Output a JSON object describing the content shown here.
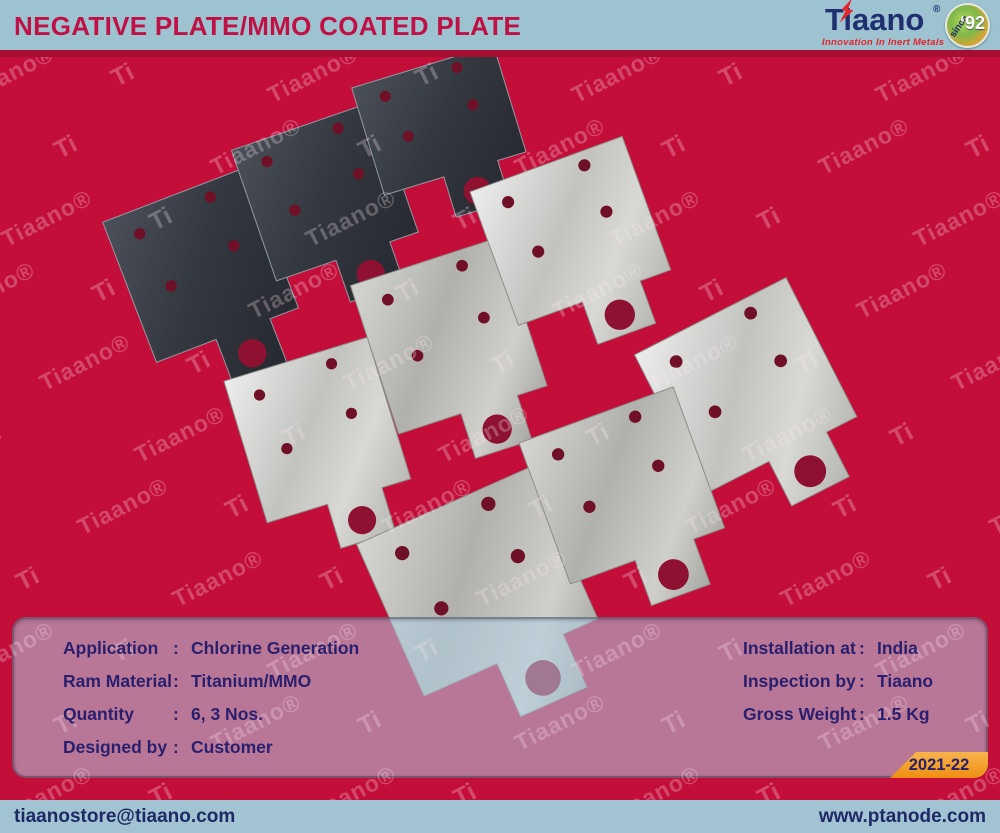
{
  "header": {
    "title": "NEGATIVE PLATE/MMO COATED PLATE",
    "logo": {
      "brand": "Tiaano",
      "registered": "®",
      "tagline": "Innovation In Inert Metals",
      "badge": {
        "since": "since",
        "year": "‘92"
      }
    }
  },
  "photo": {
    "watermark": {
      "brand": "Tiaano®",
      "short": "Ti"
    },
    "colors": {
      "background": "#c30e3a",
      "hole_small": "#701026",
      "hole_big": "#8e1132",
      "dark_stroke": "#9099a3",
      "silver_stroke": "#8d8e8a"
    },
    "plates": [
      {
        "name": "mmo-coated-plate-1",
        "finish": "dark",
        "shade": "",
        "cx": 209,
        "cy": 287,
        "w": 152,
        "h": 150,
        "t": 47,
        "rot": -21
      },
      {
        "name": "mmo-coated-plate-2",
        "finish": "dark",
        "shade": "",
        "cx": 332,
        "cy": 212,
        "w": 150,
        "h": 138,
        "t": 44,
        "rot": -19
      },
      {
        "name": "mmo-coated-plate-3",
        "finish": "dark",
        "shade": "",
        "cx": 445,
        "cy": 140,
        "w": 148,
        "h": 112,
        "t": 42,
        "rot": -17
      },
      {
        "name": "titanium-plate-1",
        "finish": "silver",
        "shade": "a",
        "cx": 324,
        "cy": 452,
        "w": 150,
        "h": 148,
        "t": 46,
        "rot": -17
      },
      {
        "name": "titanium-plate-2",
        "finish": "silver",
        "shade": "b",
        "cx": 456,
        "cy": 358,
        "w": 156,
        "h": 156,
        "t": 47,
        "rot": -18
      },
      {
        "name": "titanium-plate-3",
        "finish": "silver",
        "shade": "a",
        "cx": 578,
        "cy": 252,
        "w": 162,
        "h": 142,
        "t": 45,
        "rot": -20
      },
      {
        "name": "titanium-plate-4",
        "finish": "silver",
        "shade": "b",
        "cx": 489,
        "cy": 608,
        "w": 190,
        "h": 166,
        "t": 58,
        "rot": -24
      },
      {
        "name": "titanium-plate-5",
        "finish": "silver",
        "shade": "a",
        "cx": 757,
        "cy": 408,
        "w": 170,
        "h": 156,
        "t": 50,
        "rot": -27
      },
      {
        "name": "titanium-plate-6",
        "finish": "silver",
        "shade": "b",
        "cx": 630,
        "cy": 508,
        "w": 164,
        "h": 150,
        "t": 48,
        "rot": -20
      }
    ]
  },
  "panel": {
    "separator": ":",
    "left_rows": [
      {
        "label": "Application",
        "value": "Chlorine Generation"
      },
      {
        "label": "Ram Material",
        "value": "Titanium/MMO"
      },
      {
        "label": "Quantity",
        "value": "6, 3 Nos."
      },
      {
        "label": "Designed by",
        "value": "Customer"
      }
    ],
    "right_rows": [
      {
        "label": "Installation at",
        "value": "India"
      },
      {
        "label": "Inspection by",
        "value": "Tiaano"
      },
      {
        "label": "Gross Weight",
        "value": "1.5 Kg"
      }
    ],
    "year_badge": "2021-22"
  },
  "footer": {
    "email": "tiaanostore@tiaano.com",
    "website": "www.ptanode.com"
  },
  "colors": {
    "header_bg": "#9dc3d1",
    "title_text": "#c01144",
    "divider": "#a60d33",
    "background_red": "#c30e3a",
    "panel_text": "#2a1f6e",
    "badge_orange": "#ee8e12",
    "logo_navy": "#202f6f",
    "logo_red": "#e5242b"
  }
}
